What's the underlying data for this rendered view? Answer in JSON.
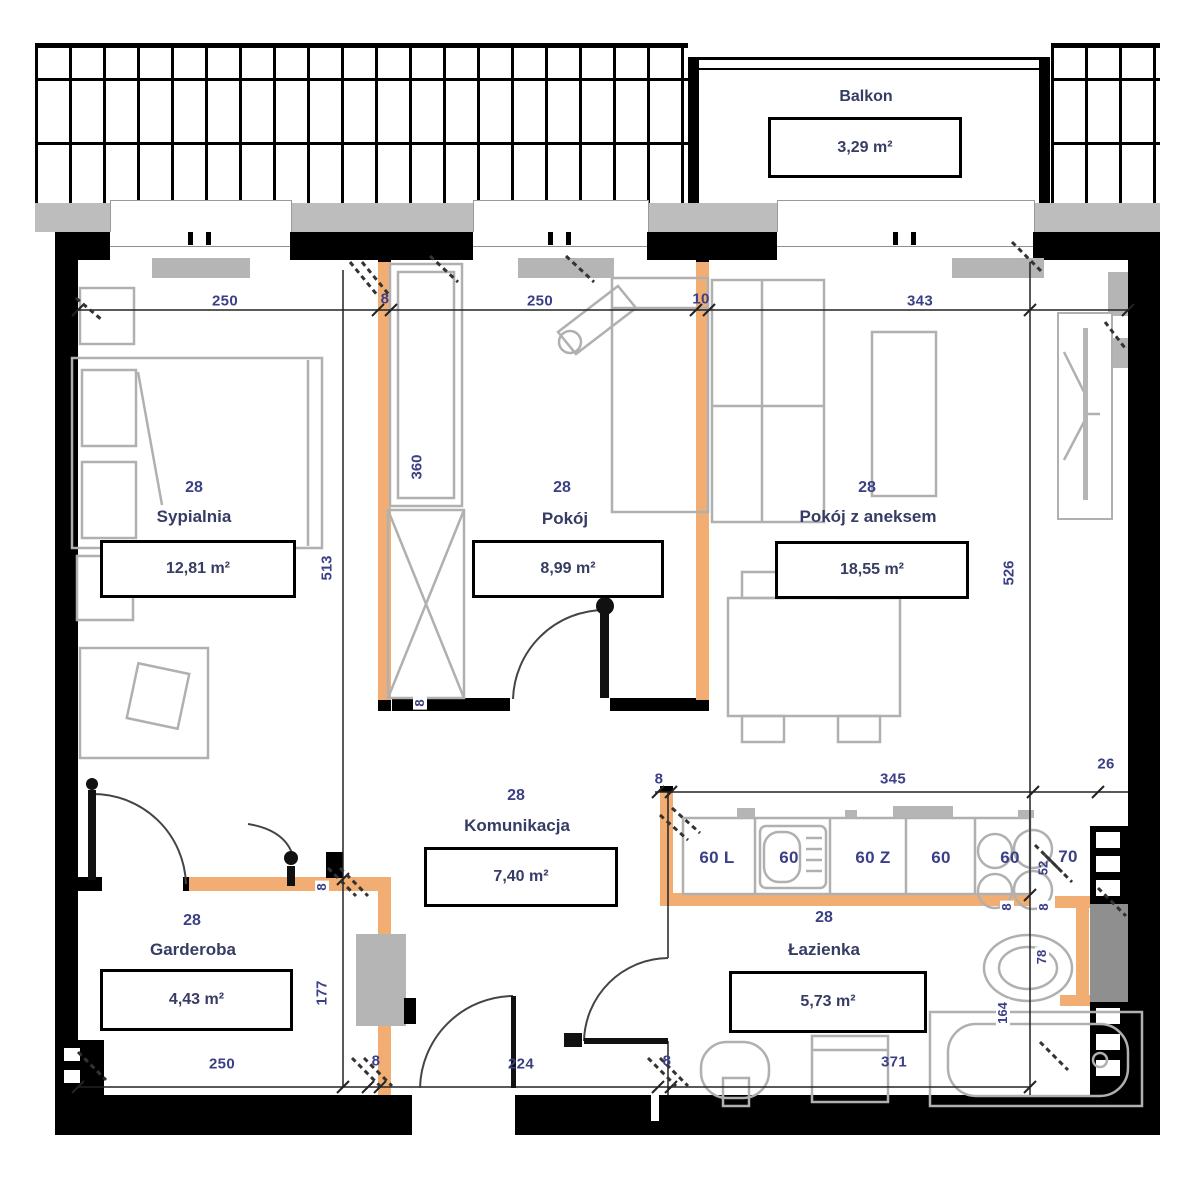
{
  "balcony": {
    "name": "Balkon",
    "area": "3,29 m²"
  },
  "rooms": [
    {
      "number": "28",
      "name": "Sypialnia",
      "area": "12,81 m²"
    },
    {
      "number": "28",
      "name": "Pokój",
      "area": "8,99 m²"
    },
    {
      "number": "28",
      "name": "Pokój z aneksem",
      "area": "18,55 m²"
    },
    {
      "number": "28",
      "name": "Komunikacja",
      "area": "7,40 m²"
    },
    {
      "number": "28",
      "name": "Garderoba",
      "area": "4,43 m²"
    },
    {
      "number": "28",
      "name": "Łazienka",
      "area": "5,73 m²"
    }
  ],
  "dimensions": {
    "top": [
      "250",
      "8",
      "250",
      "10",
      "343"
    ],
    "bottom": [
      "250",
      "8",
      "224",
      "8",
      "371"
    ],
    "kitchen_line": [
      "8",
      "345",
      "26"
    ],
    "vertical": {
      "sypialnia": "513",
      "wardrobe": "360",
      "pokoj_z_aneksem": "526",
      "garderoba": "177"
    },
    "wall_thickness": [
      "8",
      "8",
      "8",
      "8"
    ],
    "fixtures": {
      "basin": "78",
      "bath": "164",
      "hob": "52"
    }
  },
  "kitchen_units": [
    "60 L",
    "60",
    "60 Z",
    "60",
    "60",
    "70"
  ],
  "colors": {
    "partition_wall": "#F2AE72",
    "structure": "#000000",
    "furniture_line": "#B0B0B0",
    "label_text": "#3B3F85"
  }
}
